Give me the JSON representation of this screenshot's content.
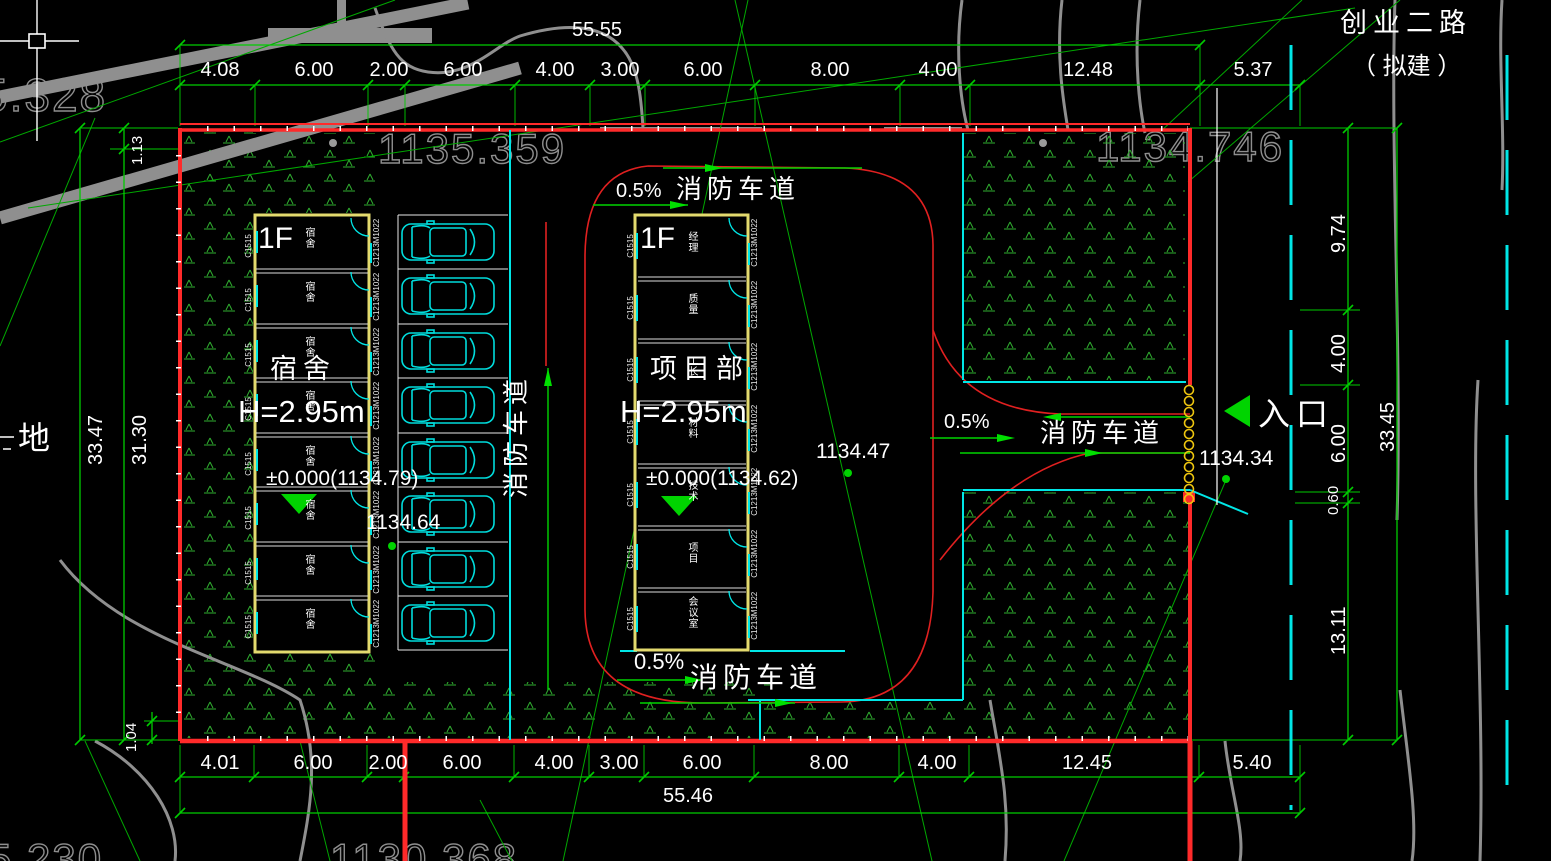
{
  "plan": {
    "road": {
      "name": "创业二路",
      "status": "（ 拟建 ）"
    },
    "adjacent_label": "地",
    "fire_lane": {
      "label": "消防车道",
      "slope": "0.5%"
    },
    "entrance": {
      "label": "入口",
      "elevation": "1134.34"
    },
    "ghost_elevations": {
      "top_left": "5.328",
      "top_center": "1135.359",
      "top_right": "1134.746",
      "bottom_left": "5.230",
      "bottom_center": "1130.368"
    },
    "dorm": {
      "floor": "1F",
      "name": "宿舍",
      "height": "H=2.95m",
      "level": "±0.000(1134.79)",
      "elevation": "1134.64",
      "rooms": [
        "宿舍",
        "宿舍",
        "宿舍",
        "宿舍",
        "宿舍",
        "宿舍",
        "宿舍",
        "宿舍"
      ]
    },
    "office": {
      "floor": "1F",
      "name": "项目部",
      "height": "H=2.95m",
      "level": "±0.000(1134.62)",
      "elevation": "1134.47",
      "rooms": [
        "经理",
        "质量",
        "工长",
        "材料",
        "技术",
        "项目",
        "会议室"
      ]
    },
    "codes": {
      "window_left": "C1515",
      "door": "M1022",
      "window_right": "C1213"
    },
    "dims": {
      "top_total": "55.55",
      "top": [
        "4.08",
        "6.00",
        "2.00",
        "6.00",
        "4.00",
        "3.00",
        "6.00",
        "8.00",
        "4.00",
        "12.48",
        "5.37"
      ],
      "bottom": [
        "4.01",
        "6.00",
        "2.00",
        "6.00",
        "4.00",
        "3.00",
        "6.00",
        "8.00",
        "4.00",
        "12.45",
        "5.40"
      ],
      "bottom_total": "55.46",
      "left": {
        "outer": "33.47",
        "inner": "31.30",
        "top": "1.13",
        "bottom": "1.04"
      },
      "right": {
        "segments": [
          "9.74",
          "4.00",
          "6.00",
          "0.60",
          "13.11"
        ],
        "total": "33.45"
      }
    }
  }
}
